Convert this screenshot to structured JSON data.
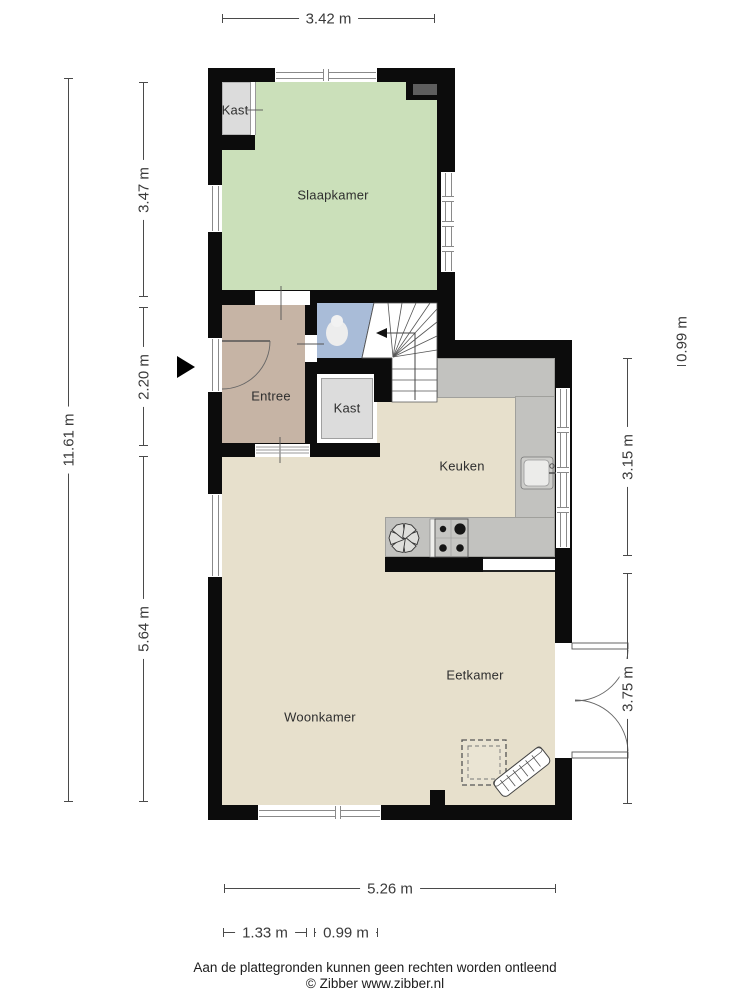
{
  "plan": {
    "type": "floorplan",
    "source": "Zibber",
    "rooms": {
      "kast_top": "Kast",
      "slaapkamer": "Slaapkamer",
      "entree": "Entree",
      "kast_mid": "Kast",
      "keuken": "Keuken",
      "eetkamer": "Eetkamer",
      "woonkamer": "Woonkamer"
    },
    "dimensions": {
      "top": "3.42 m",
      "left_total": "11.61 m",
      "left_1": "3.47 m",
      "left_2": "2.20 m",
      "left_3": "5.64 m",
      "right_1": "0.99 m",
      "right_2": "3.15 m",
      "right_3": "3.75 m",
      "bottom_total": "5.26 m",
      "bottom_1": "1.33 m",
      "bottom_2": "0.99 m"
    },
    "icons": {
      "entrance_arrow": "entrance-arrow",
      "stairs": "winder-staircase with down arrow",
      "toilet": "toilet-bowl",
      "sink": "kitchen-sink",
      "stove": "four-burner-stove",
      "extractor": "six-blade-star",
      "radiator": "radiator",
      "floor_hatch": "dashed-hatch-square"
    },
    "colors": {
      "wall": "#0c0c0c",
      "slaapkamer": "#cbe0ba",
      "entree": "#c6b4a5",
      "toilet": "#a9bcd8",
      "closet": "#dcdcdc",
      "living": "#e7e0cc",
      "counter": "#c2c2bf",
      "vent_block": "#5e5e5e"
    },
    "footer": {
      "disclaimer": "Aan de plattegronden kunnen geen rechten worden ontleend",
      "copyright": "© Zibber www.zibber.nl"
    }
  }
}
